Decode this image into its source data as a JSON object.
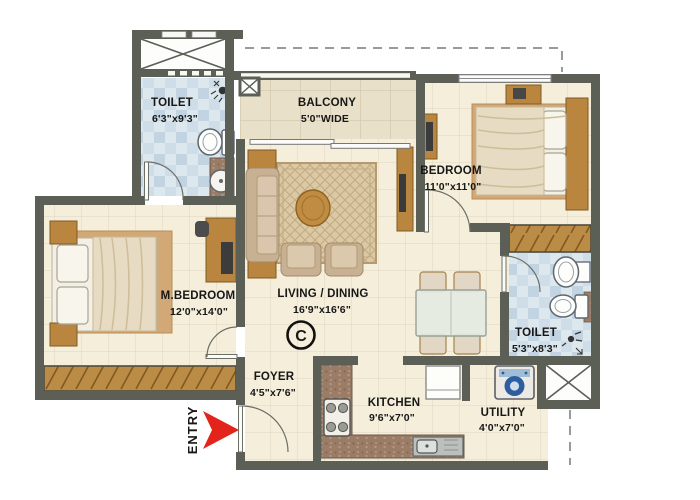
{
  "plan": {
    "entry_label": "ENTRY",
    "copyright_mark": "C",
    "rooms": {
      "toilet1": {
        "name": "TOILET",
        "dims": "6'3\"x9'3\""
      },
      "balcony": {
        "name": "BALCONY",
        "dims": "5'0\"WIDE"
      },
      "bedroom": {
        "name": "BEDROOM",
        "dims": "11'0\"x11'0\""
      },
      "mbedroom": {
        "name": "M.BEDROOM",
        "dims": "12'0\"x14'0\""
      },
      "living": {
        "name": "LIVING / DINING",
        "dims": "16'9\"x16'6\""
      },
      "toilet2": {
        "name": "TOILET",
        "dims": "5'3\"x8'3\""
      },
      "foyer": {
        "name": "FOYER",
        "dims": "4'5\"x7'6\""
      },
      "kitchen": {
        "name": "KITCHEN",
        "dims": "9'6\"x7'0\""
      },
      "utility": {
        "name": "UTILITY",
        "dims": "4'0\"x7'0\""
      }
    },
    "colors": {
      "wall": "#5b5f55",
      "entry_arrow": "#e3241b",
      "floor_cream": "#f5eedb",
      "floor_blue": "#d7e3ec",
      "wood": "#b9853f"
    }
  }
}
